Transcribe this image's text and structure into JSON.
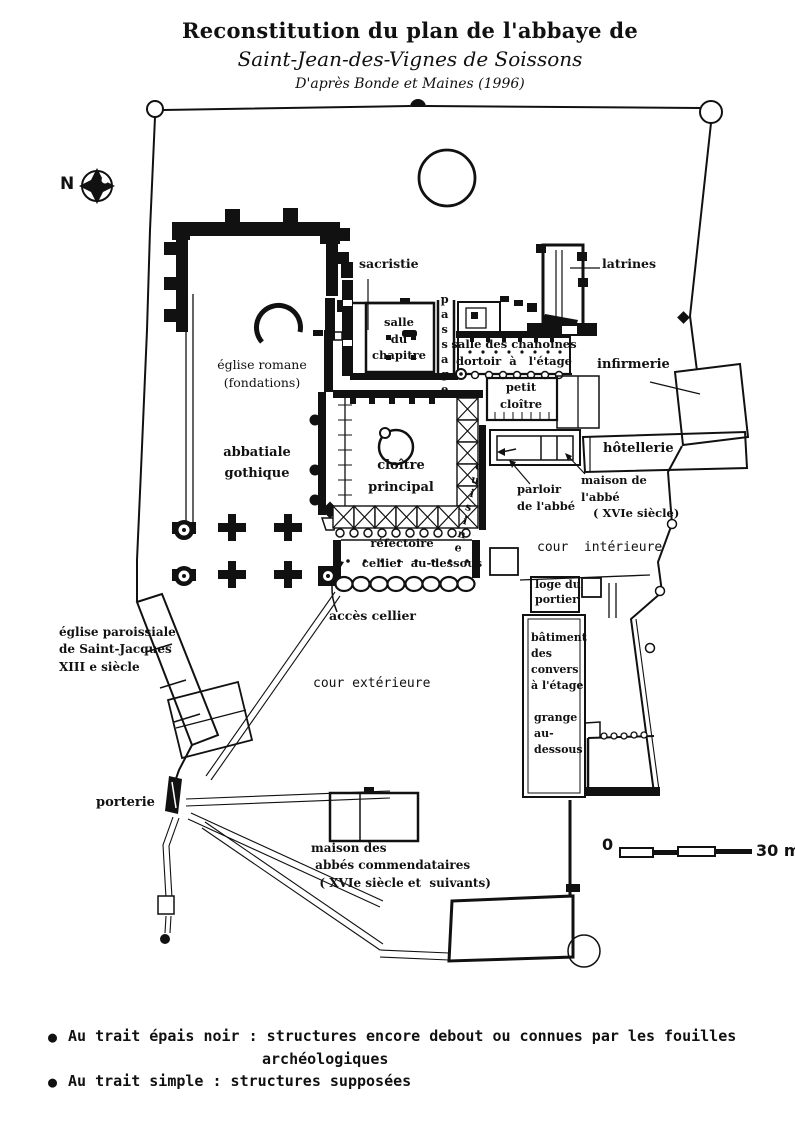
{
  "title": {
    "line1": "Reconstitution du plan de l'abbaye de",
    "line2": "Saint-Jean-des-Vignes de Soissons",
    "line3": "D'après  Bonde et Maines (1996)"
  },
  "compass": {
    "north": "N"
  },
  "plan_labels": {
    "sacristie": "sacristie",
    "latrines": "latrines",
    "salle_du_chapitre": "salle\ndu\nchapitre",
    "passage": "passage",
    "salle_des_chanoines": "salle des chanoines\ndortoir  à   l'étage",
    "petit_cloitre": "petit\ncloître",
    "infirmerie": "infirmerie",
    "eglise_romane": "église romane\n(fondations)",
    "hotellerie": "hôtellerie",
    "abbatiale_gothique": "abbatiale\ngothique",
    "cloitre_principal": "cloître\nprincipal",
    "cuisine": "cuisine",
    "parloir_abbe": "parloir\nde l'abbé",
    "maison_abbe": "maison de\nl'abbé\n   ( XVIe siècle)",
    "cour_interieure": "cour  intérieure",
    "refectoire": "réfectoire",
    "cellier": "cellier  au-dessous",
    "loge_portier": "loge du\nportier",
    "acces_cellier": "accès cellier",
    "eglise_paroissiale": "église paroissiale\nde Saint-Jacques\nXIII e siècle",
    "cour_exterieure": "cour extérieure",
    "batiment_convers": "bâtiment\ndes\nconvers\nà l'étage",
    "grange": "grange\nau-\ndessous",
    "porterie": "porterie",
    "maison_abbes": "maison des\n abbés commendataires\n  ( XVIe siècle et  suivants)"
  },
  "scale_bar": {
    "start": "0",
    "end": "30 m"
  },
  "legend": {
    "bullet": "●",
    "items": [
      {
        "text": "Au trait épais noir : structures encore debout ou connues par les fouilles",
        "text2": "archéologiques"
      },
      {
        "text": "Au trait simple : structures supposées",
        "text2": ""
      }
    ]
  }
}
